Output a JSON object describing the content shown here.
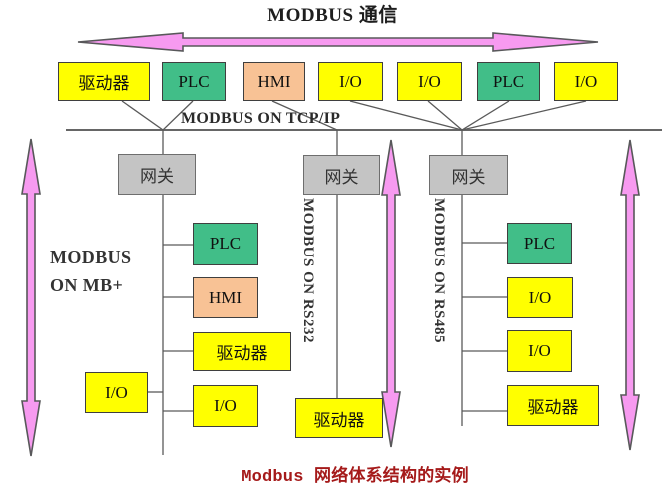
{
  "title": "MODBUS 通信",
  "bus_label": "MODBUS ON TCP/IP",
  "left_branch_label": {
    "line1": "MODBUS",
    "line2": "ON MB+"
  },
  "middle_branch_label": "MODBUS ON RS232",
  "right_branch_label": "MODBUS ON RS485",
  "caption": "Modbus 网络体系结构的实例",
  "gateways": [
    {
      "label": "网关"
    },
    {
      "label": "网关"
    },
    {
      "label": "网关"
    }
  ],
  "top_devices": [
    {
      "label": "驱动器",
      "type": "drive"
    },
    {
      "label": "PLC",
      "type": "plc"
    },
    {
      "label": "HMI",
      "type": "hmi"
    },
    {
      "label": "I/O",
      "type": "io"
    },
    {
      "label": "I/O",
      "type": "io"
    },
    {
      "label": "PLC",
      "type": "plc"
    },
    {
      "label": "I/O",
      "type": "io"
    }
  ],
  "mbplus_devices": [
    {
      "label": "PLC",
      "type": "plc"
    },
    {
      "label": "HMI",
      "type": "hmi"
    },
    {
      "label": "驱动器",
      "type": "drive"
    },
    {
      "label": "I/O",
      "type": "io"
    },
    {
      "label": "I/O",
      "type": "io"
    }
  ],
  "rs232_devices": [
    {
      "label": "驱动器",
      "type": "drive"
    }
  ],
  "rs485_devices": [
    {
      "label": "PLC",
      "type": "plc"
    },
    {
      "label": "I/O",
      "type": "io"
    },
    {
      "label": "I/O",
      "type": "io"
    },
    {
      "label": "驱动器",
      "type": "drive"
    }
  ],
  "colors": {
    "device-yellow": "#FFFF00",
    "device-green": "#41BE88",
    "device-orange": "#F8C295",
    "gateway-gray": "#C4C4C4",
    "arrow-pink": "#F79AF0",
    "caption-red": "#A51A1A"
  }
}
